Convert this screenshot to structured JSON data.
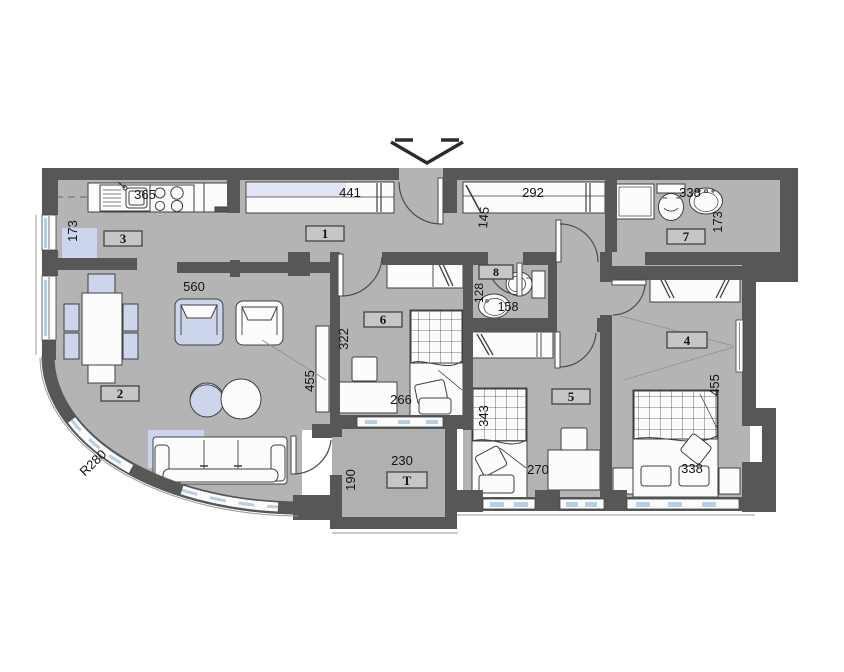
{
  "plan": {
    "title": "apartment floor plan",
    "colors": {
      "wall": "#575757",
      "floor": "#b4b4b4",
      "terrace_floor": "#b0b0b0",
      "fixture_white": "#fcfcfc",
      "accent_blue": "#cdd5ec",
      "window_blue": "#b9cde6",
      "wardrobe_lavender": "#e0e4f3"
    },
    "rooms": [
      {
        "key": "hall",
        "number": "1"
      },
      {
        "key": "living-room",
        "number": "2"
      },
      {
        "key": "kitchen",
        "number": "3"
      },
      {
        "key": "bedroom-right",
        "number": "4"
      },
      {
        "key": "bedroom-middle",
        "number": "5"
      },
      {
        "key": "bedroom-left",
        "number": "6"
      },
      {
        "key": "bathroom",
        "number": "7"
      },
      {
        "key": "wc",
        "number": "8"
      },
      {
        "key": "terrace",
        "number": "T"
      }
    ],
    "dimensions": {
      "kitchen_width": "365",
      "kitchen_depth": "173",
      "living_width": "560",
      "living_height": "455",
      "curve_radius": "R280",
      "hall_wardrobe": "441",
      "hall_depth": "145",
      "corridor_wardrobe": "292",
      "bathroom_width": "338",
      "bathroom_depth": "173",
      "wc_width": "128",
      "wc_depth": "158",
      "bedroom6_height": "322",
      "bedroom6_desk": "266",
      "terrace_width": "230",
      "terrace_depth": "190",
      "bedroom5_bed": "343",
      "bedroom5_width": "270",
      "bedroom4_height": "455",
      "bedroom4_width": "338"
    }
  }
}
